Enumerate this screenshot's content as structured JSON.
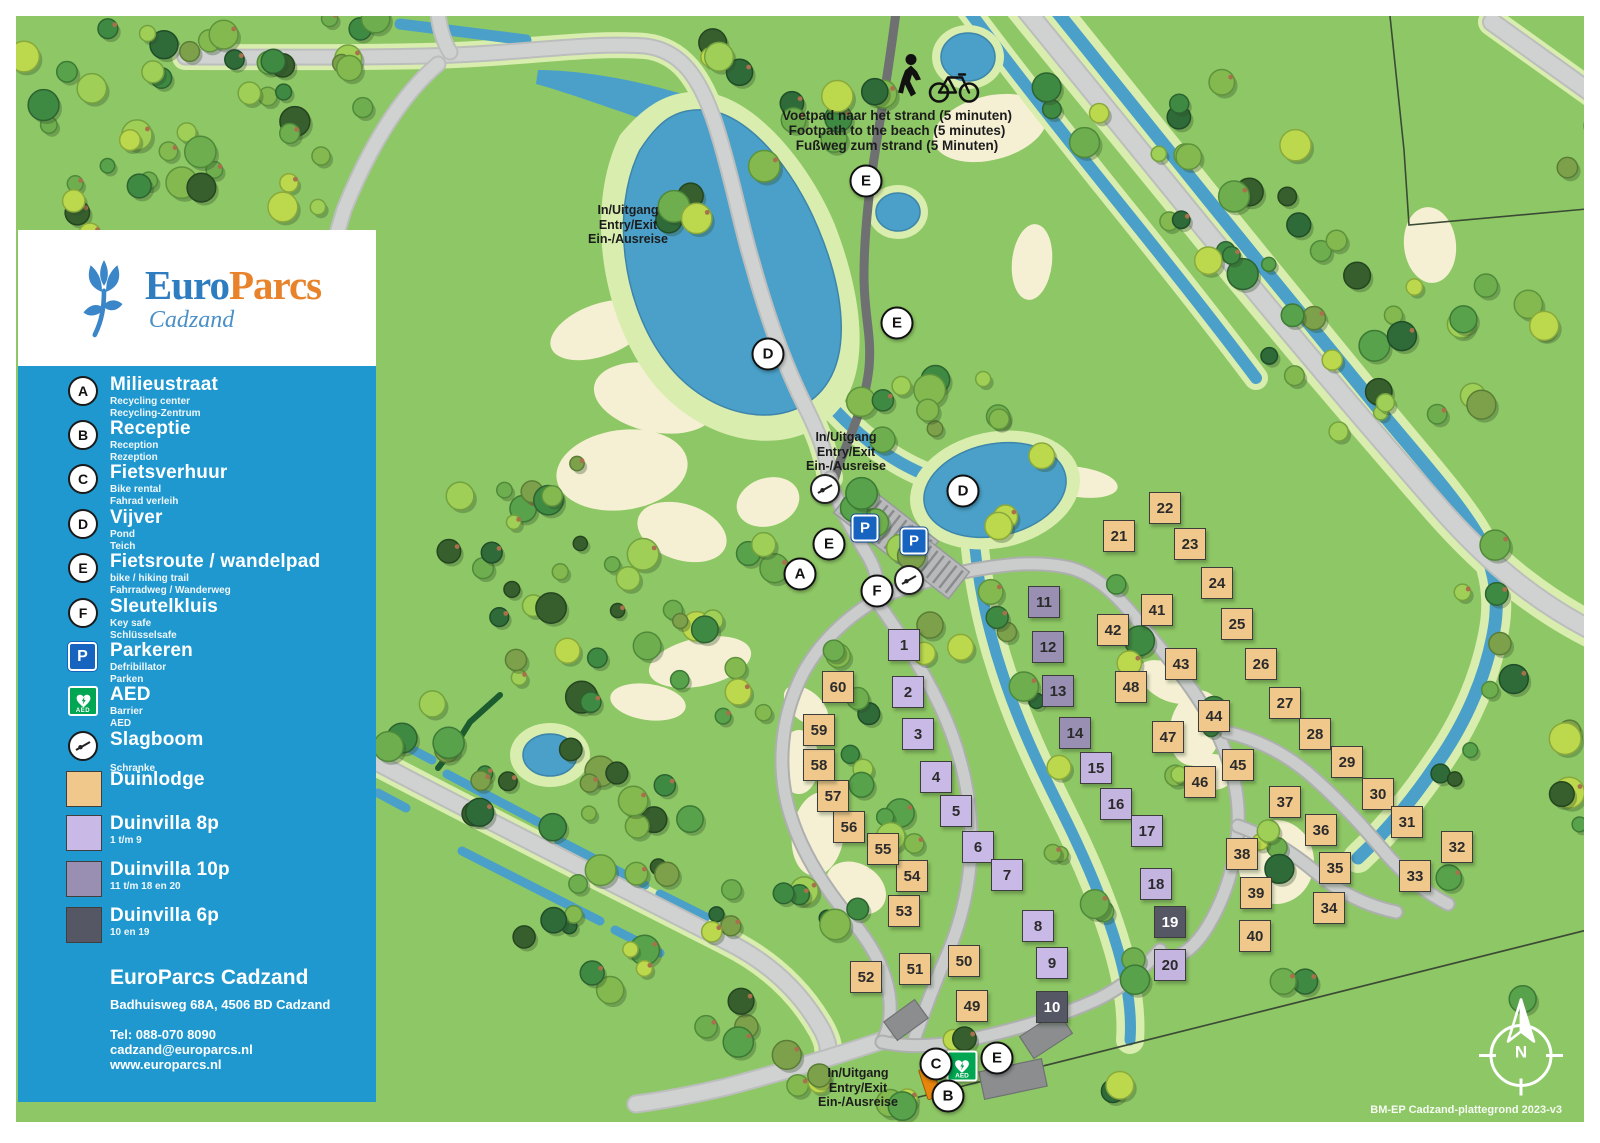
{
  "colors": {
    "grass": "#8ec765",
    "verge": "#d9edae",
    "sand": "#f5f0d3",
    "water": "#4aa0c8",
    "water_edge": "#3d85aa",
    "road": "#d0d2d1",
    "road_edge": "#bcbebd",
    "road_int": "#cbcdcc",
    "road_int_edge": "#aeb0af",
    "path_dark": "#6e7072",
    "legend_blue": "#1f98d0",
    "brand_blue": "#2f7dc1",
    "brand_orange": "#e8832c",
    "lodge": "#f0c88c",
    "v8": "#c9b9e7",
    "v10": "#988fb2",
    "v10l": "#c3b5e0",
    "v6": "#565764",
    "aed_green": "#00a651",
    "p_blue": "#1663c0",
    "building": "#8b8d8f",
    "building_orange": "#e8850c"
  },
  "logo": {
    "brand_euro": "Euro",
    "brand_parcs": "Parcs",
    "location": "Cadzand"
  },
  "legend": {
    "items": [
      {
        "kind": "letter",
        "icon_label": "A",
        "label": "Milieustraat",
        "subs": [
          "Recycling center",
          "Recycling-Zentrum"
        ],
        "y": 10
      },
      {
        "kind": "letter",
        "icon_label": "B",
        "label": "Receptie",
        "subs": [
          "Reception",
          "Rezeption"
        ],
        "y": 54
      },
      {
        "kind": "letter",
        "icon_label": "C",
        "label": "Fietsverhuur",
        "subs": [
          "Bike rental",
          "Fahrad verleih"
        ],
        "y": 98
      },
      {
        "kind": "letter",
        "icon_label": "D",
        "label": "Vijver",
        "subs": [
          "Pond",
          "Teich"
        ],
        "y": 143
      },
      {
        "kind": "letter",
        "icon_label": "E",
        "label": "Fietsroute / wandelpad",
        "subs": [
          "bike / hiking trail",
          "Fahrradweg / Wanderweg"
        ],
        "y": 187
      },
      {
        "kind": "letter",
        "icon_label": "F",
        "label": "Sleutelkluis",
        "subs": [
          "Key safe",
          "Schlüsselsafe"
        ],
        "y": 232
      },
      {
        "kind": "p",
        "icon_label": "P",
        "label": "Parkeren",
        "subs": [
          "Defribillator",
          "Parken"
        ],
        "y": 276
      },
      {
        "kind": "aed",
        "icon_label": "AED",
        "label": "AED",
        "subs": [
          "Barrier",
          "AED"
        ],
        "y": 320
      },
      {
        "kind": "slagboom",
        "label": "Slagboom",
        "subs": [
          "",
          "Schranke"
        ],
        "y": 365
      },
      {
        "kind": "swatch",
        "swatch": "lodge",
        "label": "Duinlodge",
        "subs": [],
        "y": 405
      },
      {
        "kind": "swatch",
        "swatch": "v8",
        "label": "Duinvilla 8p",
        "subs": [
          "1 t/m 9"
        ],
        "y": 449
      },
      {
        "kind": "swatch",
        "swatch": "v10",
        "label": "Duinvilla 10p",
        "subs": [
          "11 t/m 18 en 20"
        ],
        "y": 495
      },
      {
        "kind": "swatch",
        "swatch": "v6",
        "label": "Duinvilla 6p",
        "subs": [
          "10 en 19"
        ],
        "y": 541
      }
    ]
  },
  "contact": {
    "name": "EuroParcs Cadzand",
    "address": "Badhuisweg 68A, 4506 BD Cadzand",
    "tel": "Tel: 088-070 8090",
    "email": "cadzand@europarcs.nl",
    "web": "www.europarcs.nl"
  },
  "annotations": {
    "footpath": {
      "x": 897,
      "y": 108,
      "lines": [
        "Voetpad naar het strand (5 minuten)",
        "Footpath to the beach (5 minutes)",
        "Fußweg zum strand (5 Minuten)"
      ]
    },
    "entries": [
      {
        "x": 628,
        "y": 203,
        "lines": [
          "In/Uitgang",
          "Entry/Exit",
          "Ein-/Ausreise"
        ]
      },
      {
        "x": 846,
        "y": 430,
        "lines": [
          "In/Uitgang",
          "Entry/Exit",
          "Ein-/Ausreise"
        ]
      },
      {
        "x": 858,
        "y": 1066,
        "lines": [
          "In/Uitgang",
          "Entry/Exit",
          "Ein-/Ausreise"
        ]
      }
    ]
  },
  "markers": [
    {
      "label": "E",
      "x": 866,
      "y": 181
    },
    {
      "label": "E",
      "x": 897,
      "y": 323
    },
    {
      "label": "D",
      "x": 768,
      "y": 354
    },
    {
      "label": "D",
      "x": 963,
      "y": 491
    },
    {
      "label": "E",
      "x": 829,
      "y": 544
    },
    {
      "label": "A",
      "x": 800,
      "y": 574
    },
    {
      "label": "F",
      "x": 877,
      "y": 591
    },
    {
      "label": "E",
      "x": 997,
      "y": 1058
    },
    {
      "label": "C",
      "x": 936,
      "y": 1064
    },
    {
      "label": "B",
      "x": 948,
      "y": 1096
    }
  ],
  "signs": {
    "p": [
      {
        "x": 865,
        "y": 528
      },
      {
        "x": 914,
        "y": 541
      }
    ],
    "aed": [
      {
        "x": 962,
        "y": 1066
      }
    ],
    "slagboom": [
      {
        "x": 825,
        "y": 489
      },
      {
        "x": 909,
        "y": 580
      }
    ],
    "orange_building": [
      {
        "x": 930,
        "y": 1083
      }
    ],
    "aed_label": "AED"
  },
  "compass": {
    "x": 1521,
    "y": 1052,
    "label": "N"
  },
  "caption": {
    "text": "BM-EP Cadzand-plattegrond 2023-v3",
    "right": 38,
    "top": 1104
  },
  "plots": [
    {
      "n": "1",
      "t": "v8",
      "x": 904,
      "y": 645
    },
    {
      "n": "2",
      "t": "v8",
      "x": 908,
      "y": 692
    },
    {
      "n": "3",
      "t": "v8",
      "x": 918,
      "y": 734
    },
    {
      "n": "4",
      "t": "v8",
      "x": 936,
      "y": 777
    },
    {
      "n": "5",
      "t": "v8",
      "x": 956,
      "y": 811
    },
    {
      "n": "6",
      "t": "v8",
      "x": 978,
      "y": 847
    },
    {
      "n": "7",
      "t": "v8",
      "x": 1007,
      "y": 875
    },
    {
      "n": "8",
      "t": "v8",
      "x": 1038,
      "y": 926
    },
    {
      "n": "9",
      "t": "v8",
      "x": 1052,
      "y": 963
    },
    {
      "n": "10",
      "t": "v6",
      "x": 1052,
      "y": 1007
    },
    {
      "n": "11",
      "t": "v10",
      "x": 1044,
      "y": 602
    },
    {
      "n": "12",
      "t": "v10",
      "x": 1048,
      "y": 647
    },
    {
      "n": "13",
      "t": "v10",
      "x": 1058,
      "y": 691
    },
    {
      "n": "14",
      "t": "v10",
      "x": 1075,
      "y": 733
    },
    {
      "n": "15",
      "t": "v10l",
      "x": 1096,
      "y": 768
    },
    {
      "n": "16",
      "t": "v10l",
      "x": 1116,
      "y": 804
    },
    {
      "n": "17",
      "t": "v10l",
      "x": 1147,
      "y": 831
    },
    {
      "n": "18",
      "t": "v10l",
      "x": 1156,
      "y": 884
    },
    {
      "n": "19",
      "t": "v6",
      "x": 1170,
      "y": 922
    },
    {
      "n": "20",
      "t": "v10l",
      "x": 1170,
      "y": 965
    },
    {
      "n": "21",
      "t": "lodge",
      "x": 1119,
      "y": 536
    },
    {
      "n": "22",
      "t": "lodge",
      "x": 1165,
      "y": 508
    },
    {
      "n": "23",
      "t": "lodge",
      "x": 1190,
      "y": 544
    },
    {
      "n": "24",
      "t": "lodge",
      "x": 1217,
      "y": 583
    },
    {
      "n": "25",
      "t": "lodge",
      "x": 1237,
      "y": 624
    },
    {
      "n": "26",
      "t": "lodge",
      "x": 1261,
      "y": 664
    },
    {
      "n": "27",
      "t": "lodge",
      "x": 1285,
      "y": 703
    },
    {
      "n": "28",
      "t": "lodge",
      "x": 1315,
      "y": 734
    },
    {
      "n": "29",
      "t": "lodge",
      "x": 1347,
      "y": 762
    },
    {
      "n": "30",
      "t": "lodge",
      "x": 1378,
      "y": 794
    },
    {
      "n": "31",
      "t": "lodge",
      "x": 1407,
      "y": 822
    },
    {
      "n": "32",
      "t": "lodge",
      "x": 1457,
      "y": 847
    },
    {
      "n": "33",
      "t": "lodge",
      "x": 1415,
      "y": 876
    },
    {
      "n": "34",
      "t": "lodge",
      "x": 1329,
      "y": 908
    },
    {
      "n": "35",
      "t": "lodge",
      "x": 1335,
      "y": 868
    },
    {
      "n": "36",
      "t": "lodge",
      "x": 1321,
      "y": 830
    },
    {
      "n": "37",
      "t": "lodge",
      "x": 1285,
      "y": 802
    },
    {
      "n": "38",
      "t": "lodge",
      "x": 1242,
      "y": 854
    },
    {
      "n": "39",
      "t": "lodge",
      "x": 1256,
      "y": 893
    },
    {
      "n": "40",
      "t": "lodge",
      "x": 1255,
      "y": 936
    },
    {
      "n": "41",
      "t": "lodge",
      "x": 1157,
      "y": 610
    },
    {
      "n": "42",
      "t": "lodge",
      "x": 1113,
      "y": 630
    },
    {
      "n": "43",
      "t": "lodge",
      "x": 1181,
      "y": 664
    },
    {
      "n": "44",
      "t": "lodge",
      "x": 1214,
      "y": 716
    },
    {
      "n": "45",
      "t": "lodge",
      "x": 1238,
      "y": 765
    },
    {
      "n": "46",
      "t": "lodge",
      "x": 1200,
      "y": 782
    },
    {
      "n": "47",
      "t": "lodge",
      "x": 1168,
      "y": 737
    },
    {
      "n": "48",
      "t": "lodge",
      "x": 1131,
      "y": 687
    },
    {
      "n": "49",
      "t": "lodge",
      "x": 972,
      "y": 1006
    },
    {
      "n": "50",
      "t": "lodge",
      "x": 964,
      "y": 961
    },
    {
      "n": "51",
      "t": "lodge",
      "x": 915,
      "y": 969
    },
    {
      "n": "52",
      "t": "lodge",
      "x": 866,
      "y": 977
    },
    {
      "n": "53",
      "t": "lodge",
      "x": 904,
      "y": 911
    },
    {
      "n": "54",
      "t": "lodge",
      "x": 912,
      "y": 876
    },
    {
      "n": "55",
      "t": "lodge",
      "x": 883,
      "y": 849
    },
    {
      "n": "56",
      "t": "lodge",
      "x": 849,
      "y": 827
    },
    {
      "n": "57",
      "t": "lodge",
      "x": 833,
      "y": 796
    },
    {
      "n": "58",
      "t": "lodge",
      "x": 819,
      "y": 765
    },
    {
      "n": "59",
      "t": "lodge",
      "x": 819,
      "y": 730
    },
    {
      "n": "60",
      "t": "lodge",
      "x": 838,
      "y": 687
    }
  ]
}
